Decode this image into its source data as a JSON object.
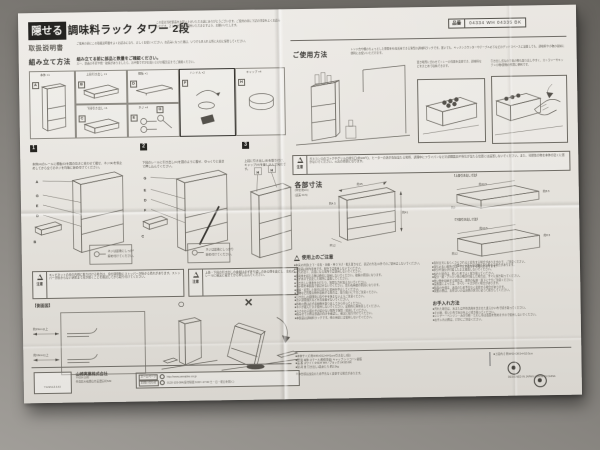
{
  "colors": {
    "paper": "#e9e6e1",
    "background": "#7c7974",
    "ink": "#3a3833"
  },
  "header": {
    "title_highlight": "隠せる",
    "title_rest": "調味料ラック タワー 2段",
    "title_note": "この度は当社製品をお買い上げいただき誠にありがとうございます。ご使用の前に下記の注意をよくお読みいただき、正しい方法でご使用いただきますよう、お願いいたします。",
    "manual_label": "取扱説明書",
    "manual_note": "ご使用の前にこの取扱説明書をよくお読みになり、正しくお使いください。お読みになった後は、いつでも見られる所に大切に保管してください。",
    "hinban_label": "品番",
    "hinban_value": "04334 WH 04335 BK"
  },
  "assembly": {
    "label": "組み立て方法",
    "note": "組み立てる前に部品と数量をご確認ください。",
    "sub_note": "万一、部品の不足や傷・破損がありましたら、お手数ですがお買い上げの販売店までご連絡ください。",
    "parts": [
      {
        "id": "A",
        "name": "本体 ×1"
      },
      {
        "id": "B",
        "name": "上段引き出し ×1"
      },
      {
        "id": "C",
        "name": "下段引き出し ×1"
      },
      {
        "id": "D",
        "name": "棚板 ×1"
      },
      {
        "id": "E",
        "name": "ネジ ×4"
      },
      {
        "id": "F",
        "name": "ハンドル ×2"
      },
      {
        "id": "G",
        "name": "スパナ ×1"
      },
      {
        "id": "H",
        "name": "キャップ ×4"
      }
    ],
    "steps": [
      {
        "num": "1",
        "text": "本体(A)のレールに棚板(D)を図の向きに合わせて載せ、ネジ(E)を仮止めしてから全てのネジを均等に締め付けてください。"
      },
      {
        "num": "2",
        "text": "下段のレールに引き出し(C)を図のように載せ、ゆっくりと奥まで押し込んでください。"
      },
      {
        "num": "3",
        "text": "上段に引き出し(B)を取り付け、キャップ(H)を差し込んで完成です。"
      }
    ],
    "step1_callouts": [
      "A",
      "G",
      "E",
      "D",
      "B"
    ],
    "step2_callouts": [
      "G",
      "E",
      "D",
      "F",
      "C"
    ],
    "step3_callouts": [
      "H",
      "H"
    ],
    "inset_line1": "ネジは最後にしっかり",
    "inset_line2": "締め付けてください。",
    "caution_label": "注意",
    "cautions": [
      "キャビネットの扉の内側に取り付ける場合は、扉の開閉時にストッパーが掛かる恐れがあります。ストッパーが掛からない状態まで扉が開くことを確認してから取り付けてください。",
      "上段・下段の引き出しの奥端は必ず折り返しのある側を奥にし、左右のレールに確実に載せてから押し込んでください。"
    ],
    "sideview_label": "【側面図】",
    "sideview_dims": [
      "約19cm以上",
      "約19cm以上"
    ],
    "ok_mark": "○",
    "ng_mark": "×"
  },
  "usage": {
    "label": "ご使用方法",
    "intro": "レンジ台や棚のちょっとした隙間を有効活用できる薄型の調味料ラックです。置いても、キッチンカウンターやテーブルの下などのデッドスペースに設置しても、調味料や小物の収納に便利にお使いいただけます。",
    "panel2_caption": "置き場所に合わせてトレーの位置を変更でき、調味料などをまとめて収納できます。",
    "panel3_caption": "引き出し式なので奥の物も取り出しやすく、カトラリーやキッチン小物/袋物の整理に便利です。",
    "caution_label": "注意",
    "caution_text": "ガスコンロのゴトクやグリルの排気口(約100℃)、ヒーターの熱が直接当たる場所、調理中にフライパンなどの調理器具や蒸気が当たる位置には設置しないでください。また、可燃性の物を本体の近くに置かないでください。火災の原因になります。"
  },
  "dimensions": {
    "label": "各部寸法",
    "unit_note": "(単位:約cm)",
    "tolerance_note": "(誤差 ±0.5)",
    "main": {
      "width": "約45",
      "height": "約41",
      "depth": "約12",
      "gap": "約4.5"
    },
    "upper_label": "【上段引き出し寸法】",
    "upper": {
      "w": "約40.5",
      "d": "約8.5",
      "h": "約9"
    },
    "lower_label": "【下段引き出し寸法】",
    "lower": {
      "w": "約40.5",
      "d": "約8.5",
      "h": "約12"
    },
    "note": "※図のイラストは実物と多少異なる場合があります。"
  },
  "precautions": {
    "label": "使用上のご注意",
    "col1": [
      "■本来の用途(上下・左右・前後・吊り下げ・据え置きなど、表記の方法)以外でのご使用はしないでください。",
      "■本製品は屋内専用です。屋外では使用しないでください。",
      "■火気の近く、高温になる場所では使用しないでください。",
      "■耐荷重を超える物は絶対に収納しないでください。破損の原因になります。",
      "■必ず水平で安定した場所に設置してください。",
      "■引き出しに体重をかけたり、無理な力を加えないでください。",
      "■お子様を本製品で遊ばせないでください。思わぬ事故の原因になります。",
      "■破損・変形した場合は直ちに使用を中止してください。",
      "■刃物など危険な物を収納する場合は、取り扱いに十分ご注意ください。",
      "■引き出しの開閉時に指や手を挟まないようご注意ください。",
      "■熱い調理器具などを直接載せないでください。",
      "■移動の際は必ず収納物を取り出してから行ってください。",
      "■ネジが緩んだまま使用しないでください。定期的に締め直してください。",
      "■小さなお子様の手の届かない場所で保管・使用してください。",
      "■組み立ての際は部品の向きを確認し、確実に取り付けてください。",
      "■本製品は調味料ラックです。他の用途には使用しないでください。"
    ],
    "col2": [
      "■直射日光に長らくさらされると変色する場合がありますので、ご注意ください。",
      "■湿気の多い場所では、サビが発生する場合があります。",
      "■水分や油分が付着したまま放置しないでください。",
      "■ぬれた場合は、乾いた布でよく拭き取ってください。",
      "■塩分・酸・アルカリ性の物が付着した場合は、すぐに拭き取ってください。",
      "■重い物を収納する場合は、本体の転倒・落下に十分ご注意ください。",
      "■設置面によっては、すべり・キズが付く場合があります。",
      "■製品の仕様は、改良のため予告なく変更する場合があります。",
      "■廃棄の際は、お住まいの自治体の区分に従って処分してください。"
    ]
  },
  "care": {
    "label": "お手入れ方法",
    "lines": [
      "■汚れた場合は、水または中性洗剤を含ませた柔らかい布で拭き取ってください。",
      "■その後、乾いた布で水分をよく拭き取ってください。",
      "■シンナー・ベンジン・みがき粉・たわし等は表面を傷めますので使用しないでください。",
      "■お手入れの際は、けがにご注意ください。"
    ]
  },
  "specs": {
    "lines": [
      "■本体サイズ 約W45×D12×H41cm(引き出し2段)",
      "■材   質 本体:スチール(粉体塗装) キャップ:シリコーン樹脂",
      "■品   番 ホワイト:04334 WH / ブラック:04335 BK",
      "■耐 荷 重 引き出し1段あたり:約2.5kg"
    ],
    "extra": "■上段内寸 約W42×D8.5×H10.5cm",
    "footnote": "※本仕様は改良のため予告なく変更する場合があります。"
  },
  "footer": {
    "logo": "YAMAZAKI",
    "company": "山崎実業株式会社",
    "zip": "〒639-1185",
    "address": "奈良県大和郡山市美濃庄町529",
    "web_label": "ホームページ",
    "web": "http://www.yamajitsu.co.jp",
    "tel_label": "お問い合わせ",
    "tel": "0120-105-084(受付時間 9:00〜17:00 土・日・祝日を除く)",
    "made_in": "DESIGNED IN JAPAN / MADE IN CHINA"
  }
}
